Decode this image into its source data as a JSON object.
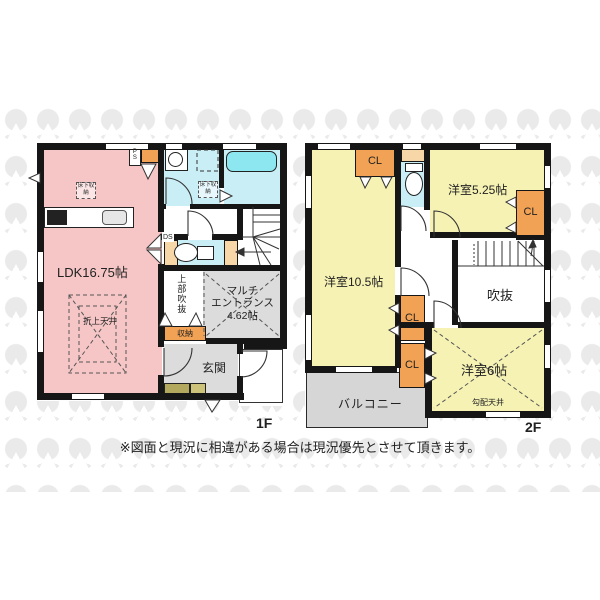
{
  "colors": {
    "ldk_pink": "#f6c6c6",
    "room_yellow": "#f6f2b4",
    "wet_cyan": "#c9eef5",
    "tub_cyan": "#8de7f0",
    "closet_orange": "#f2a254",
    "shelf_peach": "#f7d6a8",
    "hall_gray": "#dcdcdc",
    "balcony_gray": "#d6d6d6",
    "cabinet_olive": "#b3a95e",
    "cabinet_olive2": "#ccc27a",
    "wall": "#161616",
    "watermark": "#eaeaea"
  },
  "disclaimer": "※図面と現況に相違がある場合は現況優先とさせて頂きます。",
  "floor1": {
    "label": "1F",
    "ldk_label": "LDK16.75帖",
    "coffered_ceiling": "折上天井",
    "underfloor_storage_ldk": "床下収納",
    "underfloor_storage_wash": "床下収納",
    "upper_void": "上部吹抜",
    "multi_entrance_line1": "マルチ",
    "multi_entrance_line2": "エントランス",
    "multi_entrance_size": "4.62帖",
    "storage": "収納",
    "entrance": "玄関",
    "pipe_space": "PS",
    "duct_space": "DS"
  },
  "floor2": {
    "label": "2F",
    "room_a": "洋室5.25帖",
    "room_b": "洋室10.5帖",
    "room_c": "洋室6帖",
    "void_label": "吹抜",
    "sloped_ceiling": "勾配天井",
    "balcony": "バルコニー",
    "closet1": "CL",
    "closet2": "CL",
    "closet3": "CL",
    "closet4": "CL"
  }
}
